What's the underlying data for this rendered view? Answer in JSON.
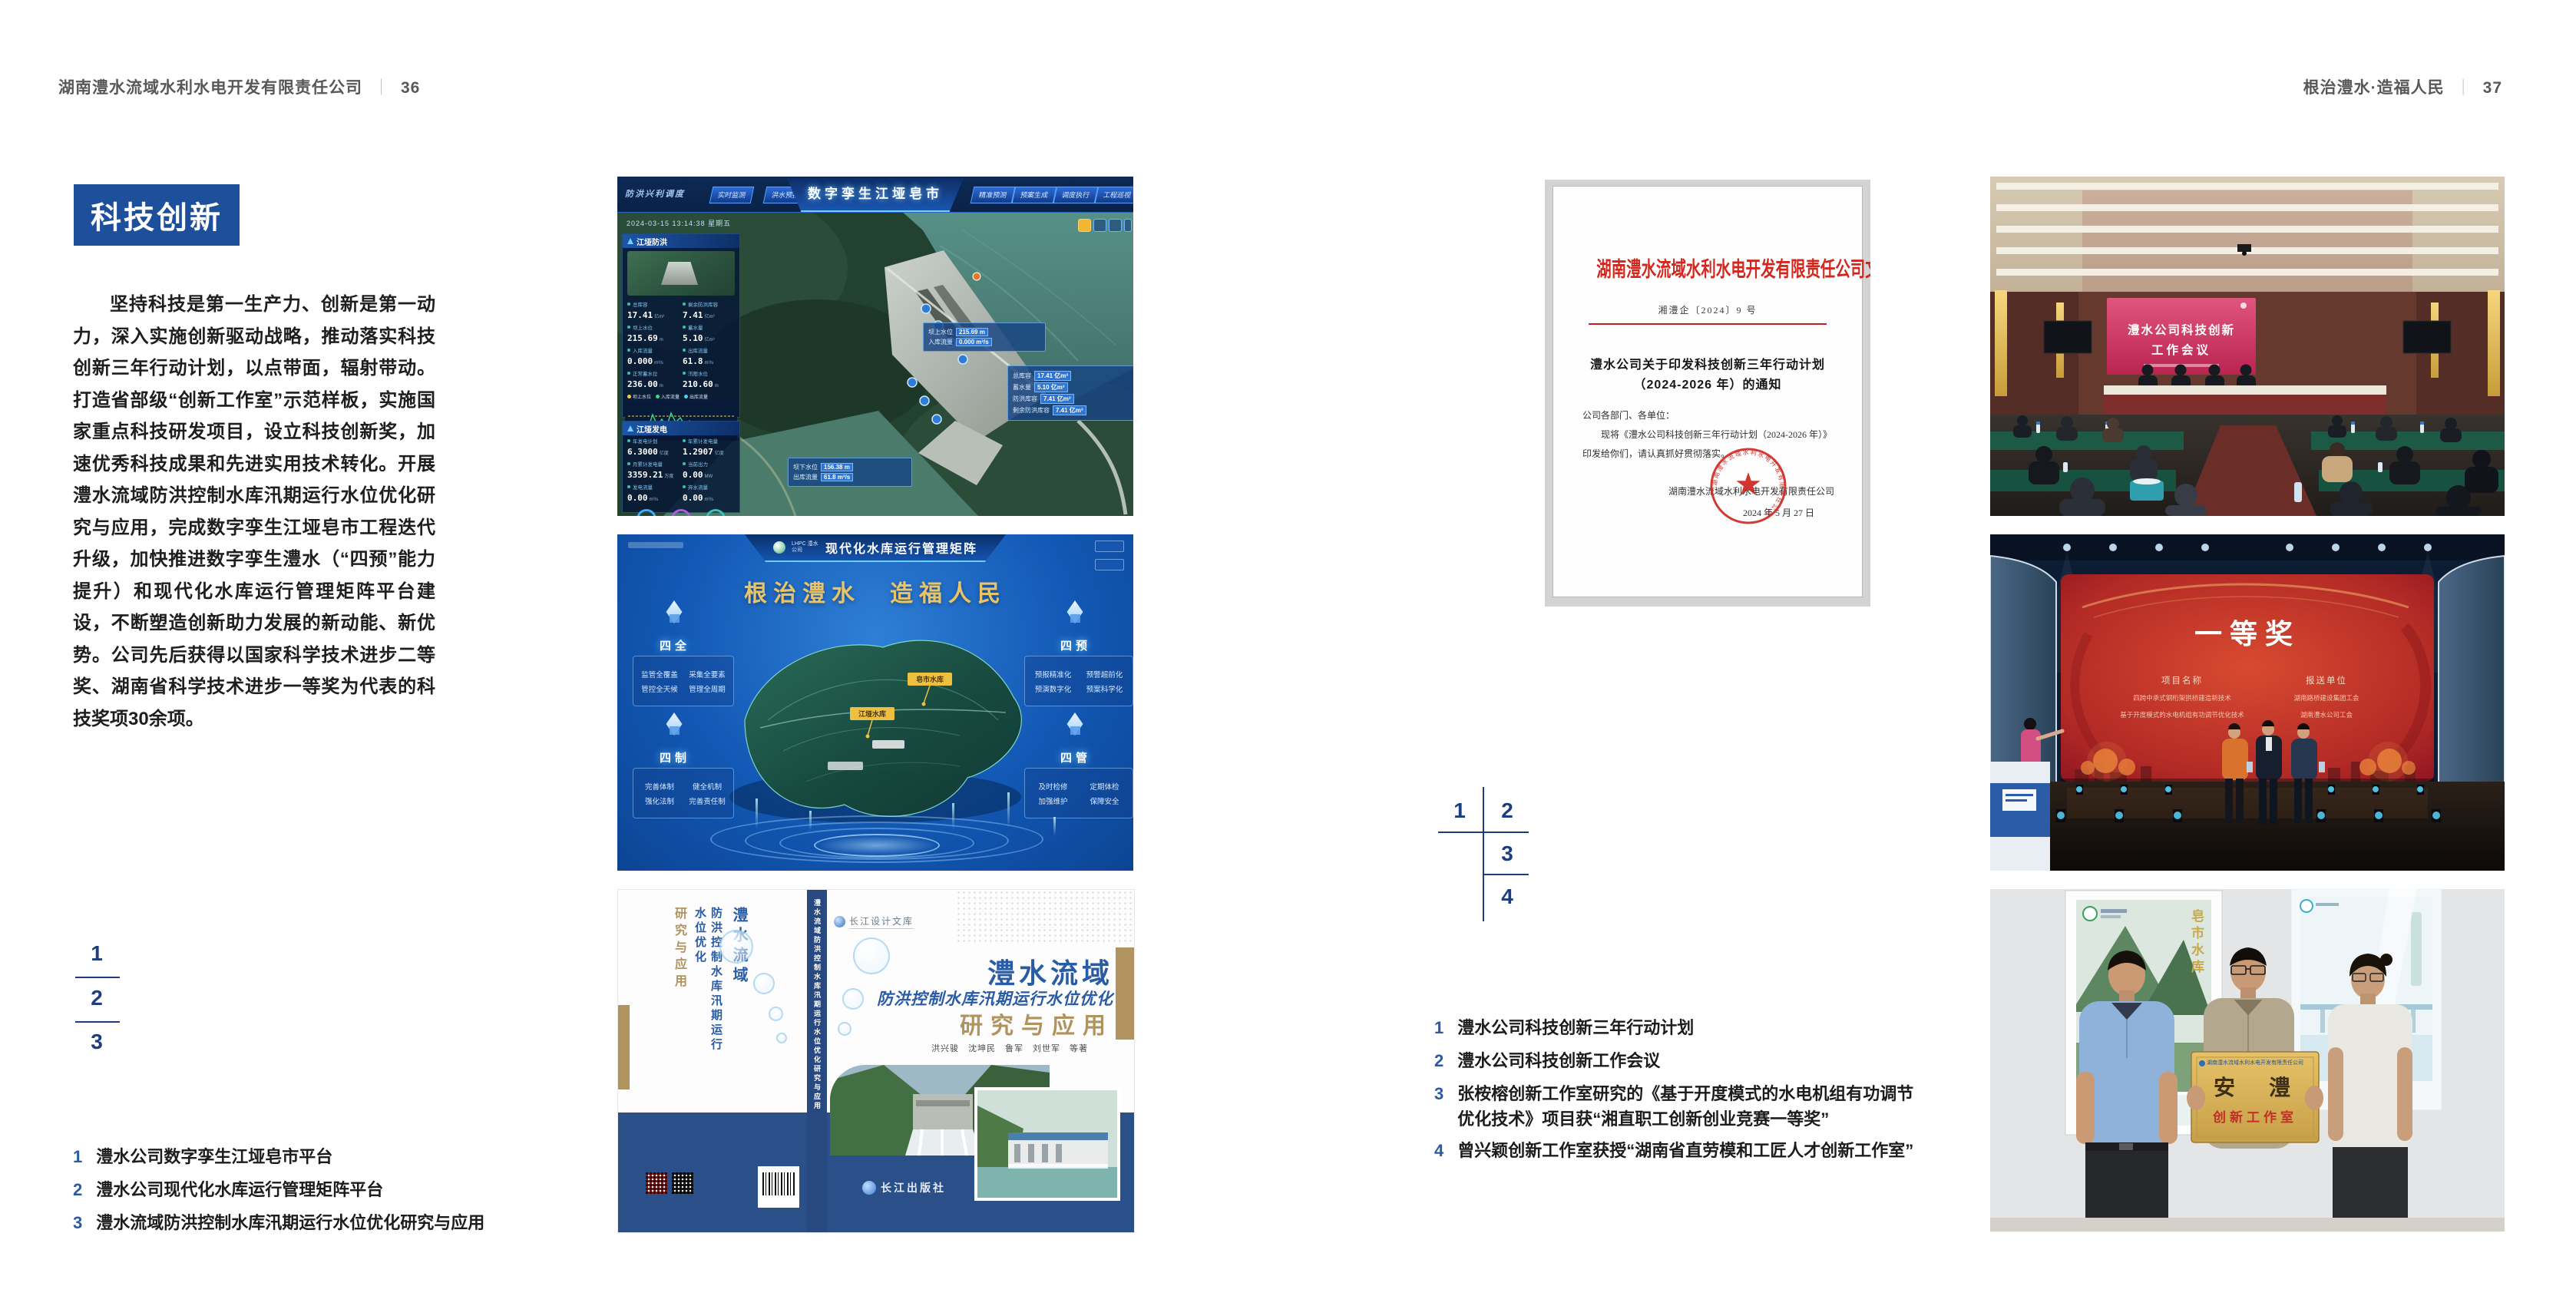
{
  "left_page": {
    "header_title": "湖南澧水流域水利水电开发有限责任公司",
    "header_sep": "｜",
    "header_page": "36",
    "section_title": "科技创新",
    "body_paragraph": "坚持科技是第一生产力、创新是第一动力，深入实施创新驱动战略，推动落实科技创新三年行动计划，以点带面，辐射带动。打造省部级“创新工作室”示范样板，实施国家重点科技研发项目，设立科技创新奖，加速优秀科技成果和先进实用技术转化。开展澧水流域防洪控制水库汛期运行水位优化研究与应用，完成数字孪生江垭皂市工程迭代升级，加快推进数字孪生澧水（“四预”能力提升）和现代化水库运行管理矩阵平台建设，不断塑造创新助力发展的新动能、新优势。公司先后获得以国家科学技术进步二等奖、湖南省科学技术进步一等奖为代表的科技奖项30余项。",
    "figure_markers": [
      "1",
      "2",
      "3"
    ],
    "captions": [
      {
        "num": "1",
        "text": "澧水公司数字孪生江垭皂市平台"
      },
      {
        "num": "2",
        "text": "澧水公司现代化水库运行管理矩阵平台"
      },
      {
        "num": "3",
        "text": "澧水流域防洪控制水库汛期运行水位优化研究与应用"
      }
    ]
  },
  "right_page": {
    "header_title": "根治澧水·造福人民",
    "header_sep": "｜",
    "header_page": "37",
    "figure_markers": [
      "1",
      "2",
      "3",
      "4"
    ],
    "captions": [
      {
        "num": "1",
        "text": "澧水公司科技创新三年行动计划"
      },
      {
        "num": "2",
        "text": "澧水公司科技创新工作会议"
      },
      {
        "num": "3",
        "text": "张桉榕创新工作室研究的《基于开度模式的水电机组有功调节优化技术》项目获“湘直职工创新创业竞赛一等奖”"
      },
      {
        "num": "4",
        "text": "曾兴颖创新工作室获授“湖南省直劳模和工匠人才创新工作室”"
      }
    ]
  },
  "fig_digital_twin": {
    "title": "数字孪生江垭皂市",
    "datetime": "2024-03-15 13:14:38 星期五",
    "nav_label": "防洪兴利调度",
    "tabs_left": [
      "实时监测",
      "洪水预报",
      "防洪预演"
    ],
    "tabs_right": [
      "精准预测",
      "预案生成",
      "调度执行",
      "工程巡视"
    ],
    "panel1": {
      "title": "江垭防洪",
      "stats": [
        {
          "label": "总库容",
          "value": "17.41",
          "unit": "亿m³"
        },
        {
          "label": "剩余防洪库容",
          "value": "7.41",
          "unit": "亿m³"
        },
        {
          "label": "坝上水位",
          "value": "215.69",
          "unit": "m"
        },
        {
          "label": "蓄水量",
          "value": "5.10",
          "unit": "亿m³"
        },
        {
          "label": "入库流量",
          "value": "0.000",
          "unit": "m³/s"
        },
        {
          "label": "出库流量",
          "value": "61.8",
          "unit": "m³/s"
        },
        {
          "label": "正常蓄水位",
          "value": "236.00",
          "unit": "m"
        },
        {
          "label": "汛限水位",
          "value": "210.60",
          "unit": "m"
        }
      ],
      "legend": [
        "坝上水位",
        "入库流量",
        "出库流量"
      ]
    },
    "panel2": {
      "title": "江垭发电",
      "stats": [
        {
          "label": "年发电计划",
          "value": "6.3000",
          "unit": "亿度"
        },
        {
          "label": "年累计发电量",
          "value": "1.2907",
          "unit": "亿度"
        },
        {
          "label": "月累计发电量",
          "value": "3359.21",
          "unit": "万度"
        },
        {
          "label": "当前出力",
          "value": "0.00",
          "unit": "MW"
        },
        {
          "label": "发电流量",
          "value": "0.00",
          "unit": "m³/s"
        },
        {
          "label": "弃水流量",
          "value": "0.00",
          "unit": "m³/s"
        }
      ]
    },
    "tooltips": {
      "t1": [
        {
          "label": "坝上水位",
          "value": "215.69 m"
        },
        {
          "label": "入库流量",
          "value": "0.000 m³/s"
        }
      ],
      "t2": [
        {
          "label": "总库容",
          "value": "17.41 亿m³"
        },
        {
          "label": "蓄水量",
          "value": "5.10 亿m³"
        },
        {
          "label": "防洪库容",
          "value": "7.41 亿m³"
        },
        {
          "label": "剩余防洪库容",
          "value": "7.41 亿m³"
        }
      ],
      "t3": [
        {
          "label": "坝下水位",
          "value": "156.38 m"
        },
        {
          "label": "出库流量",
          "value": "61.8 m³/s"
        }
      ]
    }
  },
  "fig_matrix": {
    "logo_text": "LHPC 澧水公司",
    "title": "现代化水库运行管理矩阵",
    "slogan": "根治澧水　造福人民",
    "groups": [
      {
        "title": "四全",
        "items": [
          "监管全覆盖",
          "采集全要素",
          "管控全天候",
          "管理全周期"
        ]
      },
      {
        "title": "四预",
        "items": [
          "预报精准化",
          "预警超前化",
          "预演数字化",
          "预案科学化"
        ]
      },
      {
        "title": "四制",
        "items": [
          "完善体制",
          "健全机制",
          "强化法制",
          "完善责任制"
        ]
      },
      {
        "title": "四管",
        "items": [
          "及时检修",
          "定期体检",
          "加强维护",
          "保障安全"
        ]
      }
    ],
    "map_labels": [
      "皂市水库",
      "江垭水库"
    ]
  },
  "fig_book": {
    "series_logo": "长江设计文库",
    "title_main": "澧水流域",
    "title_sub": "防洪控制水库汛期运行水位优化",
    "title_accent": "研究与应用",
    "authors": "洪兴骏　沈坤民　鲁军　刘世军　等著",
    "spine_text": "澧水流域防洪控制水库汛期运行水位优化研究与应用",
    "publisher": "长江出版社",
    "back_title_1": "澧水流域",
    "back_title_2": "防洪控制水库汛期运行水位优化",
    "back_title_3": "研究与应用"
  },
  "fig_document": {
    "red_header": "湖南澧水流域水利水电开发有限责任公司文件",
    "doc_number": "湘澧企〔2024〕9 号",
    "title_line1": "澧水公司关于印发科技创新三年行动计划",
    "title_line2": "（2024-2026 年）的通知",
    "salutation": "公司各部门、各单位：",
    "body": "现将《澧水公司科技创新三年行动计划（2024-2026 年）》印发给你们，请认真抓好贯彻落实。",
    "signature": "湖南澧水流域水利水电开发有限责任公司",
    "date": "2024 年 5 月 27 日",
    "seal_text": "湖南澧水流域水利水电开发有限责任公司"
  },
  "fig_meeting": {
    "screen_line1": "澧水公司科技创新",
    "screen_line2": "工作会议"
  },
  "fig_award": {
    "screen_title": "一等奖",
    "col1_header": "项目名称",
    "col2_header": "报送单位",
    "col1_rows": [
      "四跨中承式钢桁架拱桥建造新技术",
      "基于开度模式的水电机组有功调节优化技术"
    ],
    "col2_rows": [
      "湖南路桥建设集团工会",
      "湖南澧水公司工会"
    ]
  },
  "fig_plaque": {
    "plaque_header": "湖南澧水流域水利水电开发有限责任公司",
    "plaque_main": "安　澧",
    "plaque_sub": "创新工作室",
    "poster_left_label": "皂市水库"
  }
}
